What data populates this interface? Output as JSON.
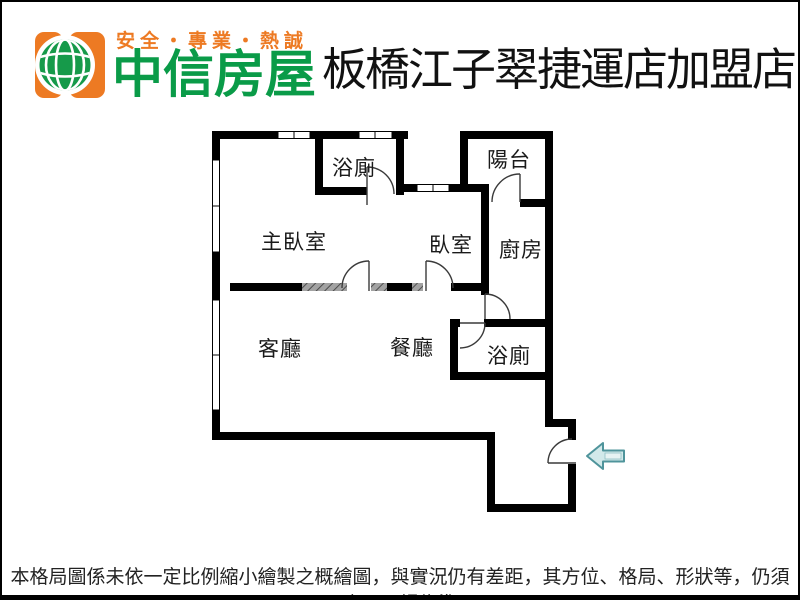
{
  "header": {
    "slogan": "安全・專業・熱誠",
    "brand": "中信房屋",
    "store": "板橋江子翠捷運店加盟店",
    "logo_icon": "chinatrust-globe-logo"
  },
  "floorplan": {
    "rooms": [
      {
        "id": "bath-top",
        "label": "浴廁"
      },
      {
        "id": "balcony",
        "label": "陽台"
      },
      {
        "id": "master-bedroom",
        "label": "主臥室"
      },
      {
        "id": "bedroom",
        "label": "臥室"
      },
      {
        "id": "kitchen",
        "label": "廚房"
      },
      {
        "id": "living-room",
        "label": "客廳"
      },
      {
        "id": "dining-room",
        "label": "餐廳"
      },
      {
        "id": "bath-bottom",
        "label": "浴廁"
      }
    ],
    "entrance_arrow_direction": "left"
  },
  "footer": {
    "disclaimer": "本格局圖係未依一定比例縮小繪製之概繪圖，與實況仍有差距，其方位、格局、形狀等，仍須以房屋現場為準。"
  },
  "colors": {
    "brand_orange": "#ED7A23",
    "brand_green": "#0A9B48",
    "wall_black": "#000000",
    "arrow_fill": "#D2E9EA",
    "arrow_stroke": "#4F949B"
  }
}
